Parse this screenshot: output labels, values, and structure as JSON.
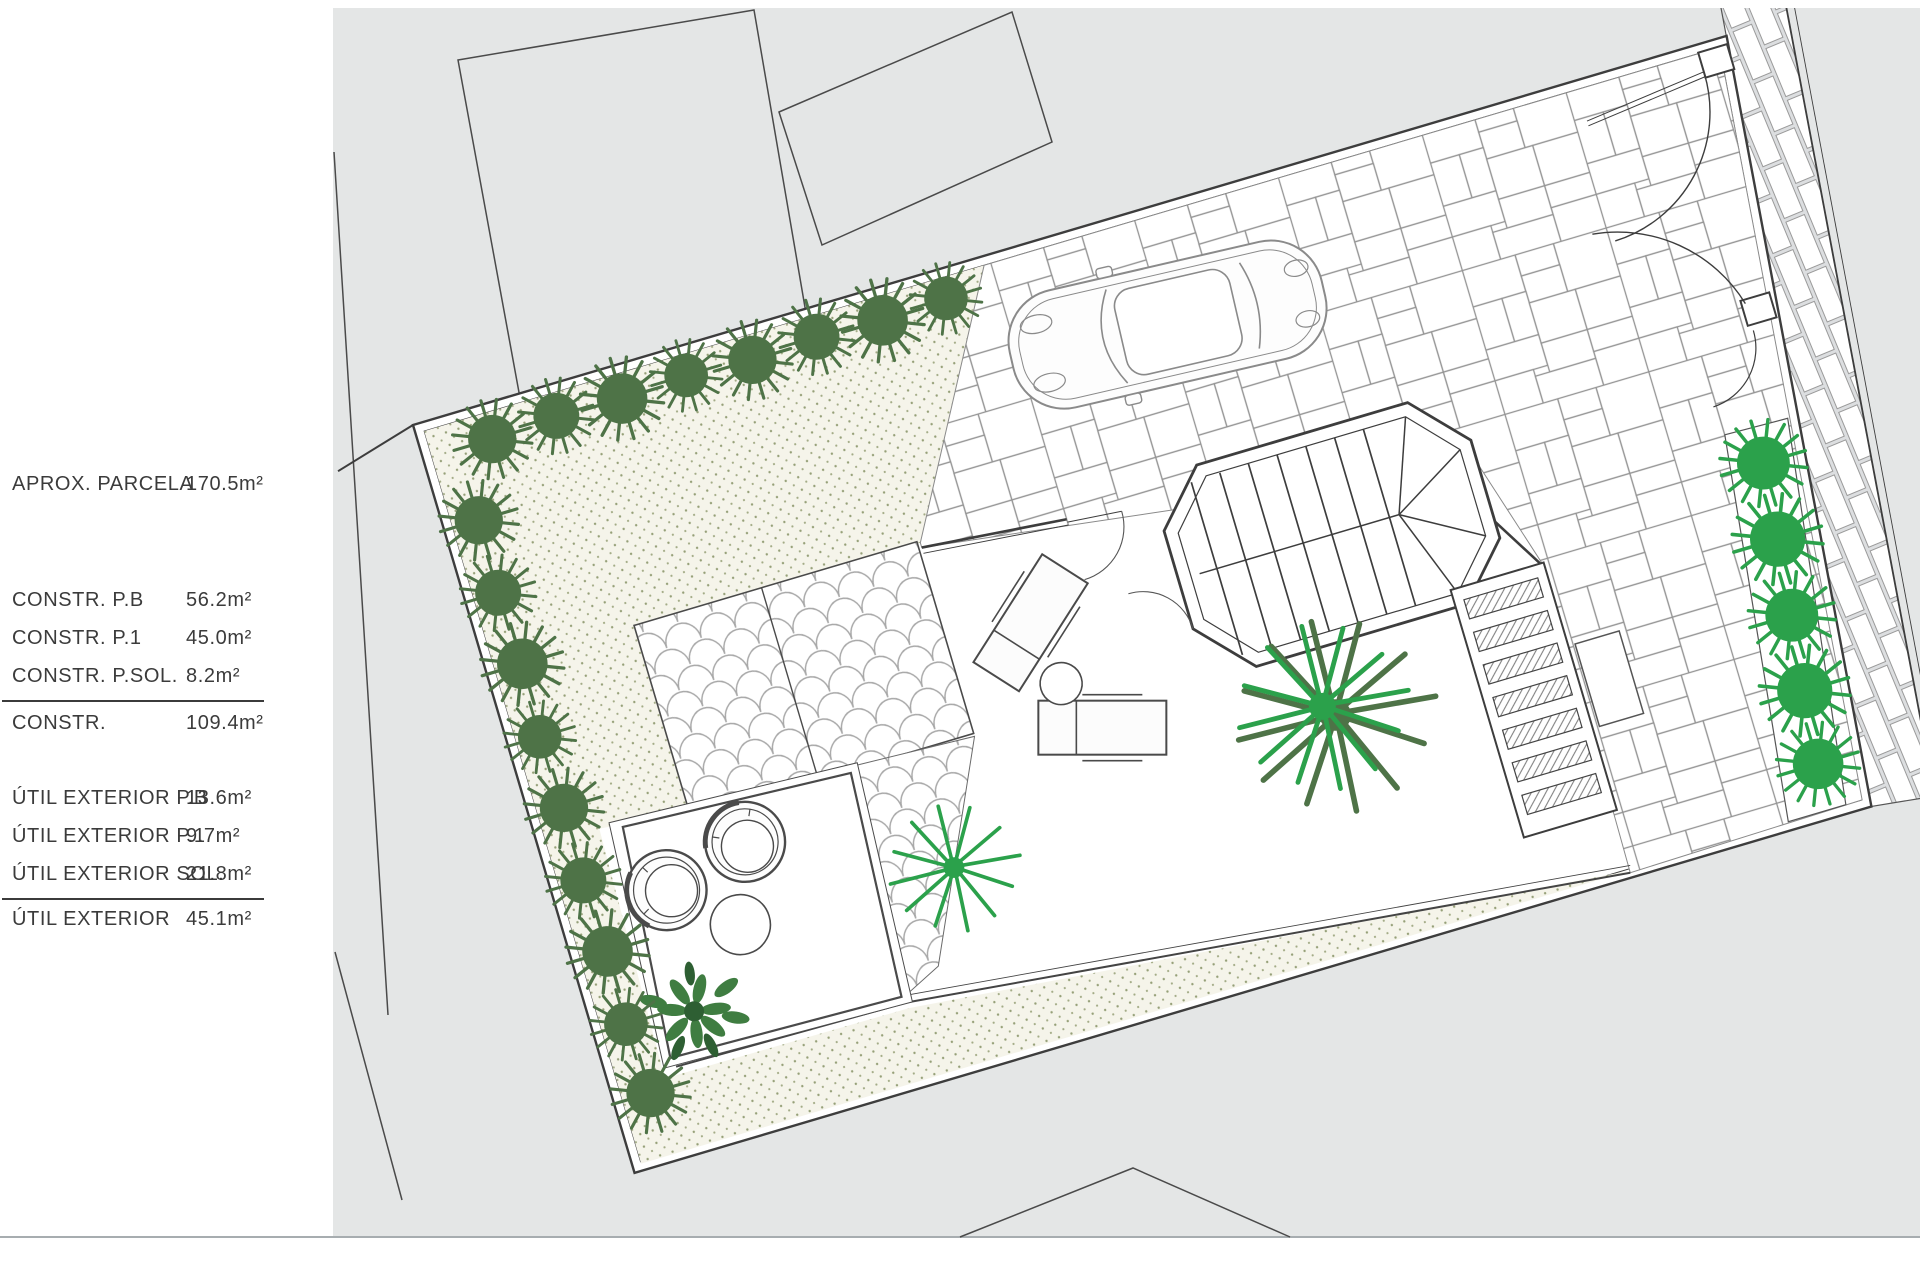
{
  "document": {
    "type": "site-plan-drawing",
    "language": "es"
  },
  "area_table": {
    "rows": [
      {
        "label": "APROX.  PARCELA",
        "value": "170.5m²"
      },
      {
        "label": "CONSTR.  P.B",
        "value": "56.2m²"
      },
      {
        "label": "CONSTR.  P.1",
        "value": "45.0m²"
      },
      {
        "label": "CONSTR.  P.SOL.",
        "value": "8.2m²"
      },
      {
        "label": "CONSTR.",
        "value": "109.4m²"
      },
      {
        "label": "ÚTIL  EXTERIOR  P.B",
        "value": "13.6m²"
      },
      {
        "label": "ÚTIL  EXTERIOR  P.1",
        "value": "9.7m²"
      },
      {
        "label": "ÚTIL  EXTERIOR  SOL.",
        "value": "21.8m²"
      },
      {
        "label": "ÚTIL  EXTERIOR",
        "value": "45.1m²"
      }
    ]
  },
  "drawing_elements": {
    "parcel": "rotated parcel boundary with double wall line",
    "garden": "stippled gravel garden with hedge of shrubs on north and west edges",
    "driveway": "random stone paving with parked car",
    "stair_tower": "octagonal stair tower with treads and winders",
    "cobble_square": "two-panel fish-scale cobble terrace",
    "patio": "square patio with two tub chairs, round table and tree",
    "pergola": "slatted pergola deck",
    "gates": "vehicle double gate and pedestrian gate with swing arcs",
    "sidewalk": "brick sidewalk strip with curb along street",
    "planting_strip": "five bright shrubs along east boundary"
  },
  "colors": {
    "canvas_gray": "#e4e6e6",
    "ink": "#3d3d3d",
    "garden_bg": "#f5f4ea",
    "garden_dot": "#96a078",
    "shrub_dark": "#4e7347",
    "shrub_bright": "#2ba14b",
    "paving_joint": "#949494"
  }
}
